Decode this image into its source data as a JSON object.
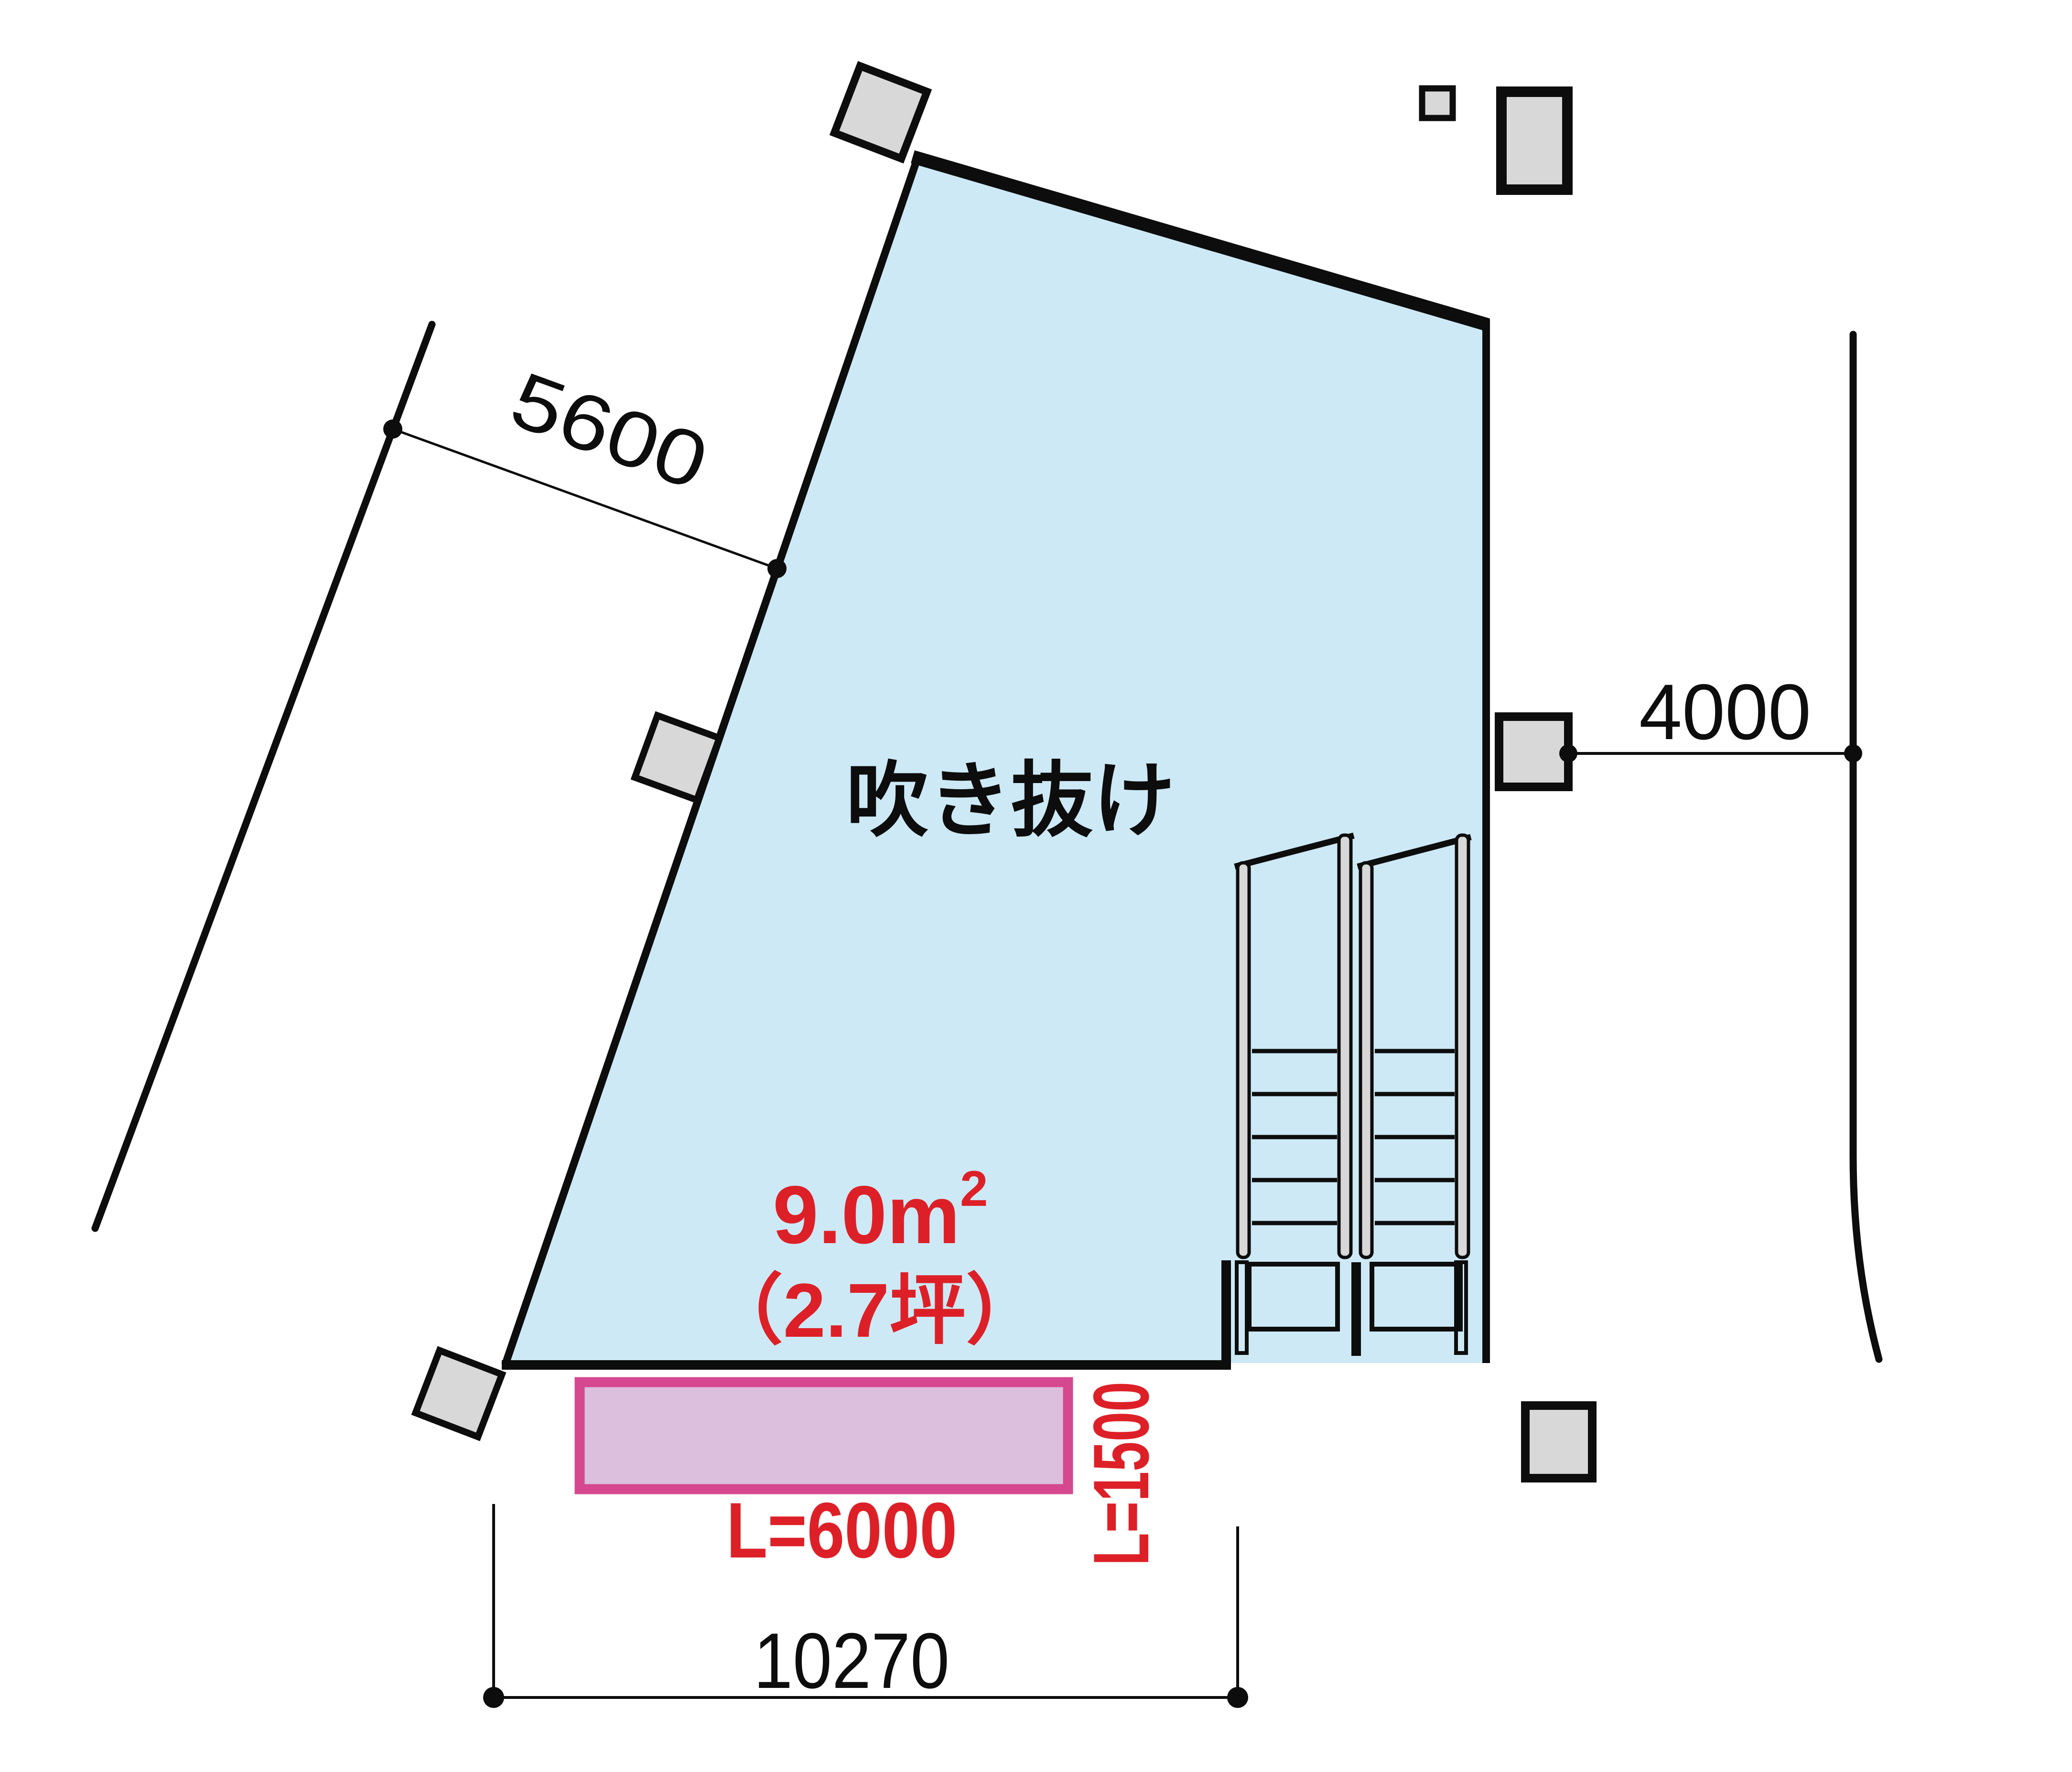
{
  "diagram": {
    "type": "architectural-plan",
    "room_label": "吹き抜け",
    "area_label": {
      "value_main": "9.0m",
      "value_sup": "2",
      "value_tsubo": "（2.7坪）"
    },
    "dimensions": {
      "upper_left": "5600",
      "right": "4000",
      "bottom": "10270",
      "louver_length": "L=6000",
      "louver_depth": "L=1500"
    },
    "colors": {
      "void_fill": "#cde9f6",
      "column_fill": "#d8d8d8",
      "louver_fill": "#dcbedd",
      "louver_border": "#d5488f",
      "annotation_red": "#dd2027",
      "line_black": "#0d0d0d"
    }
  }
}
